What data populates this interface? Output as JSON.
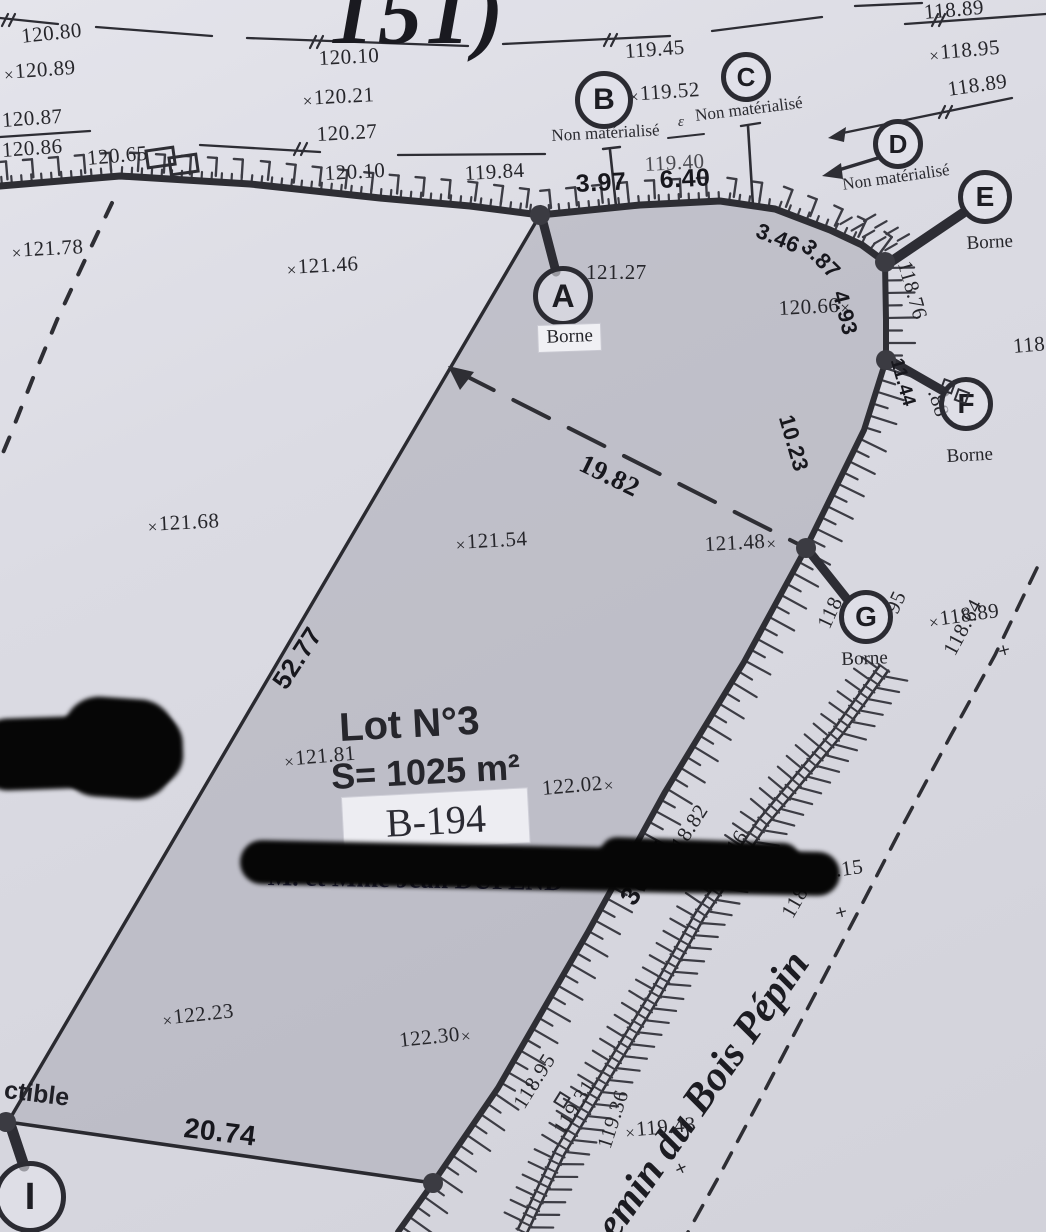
{
  "title_fragment": "151)",
  "labels": {
    "borne": "Borne",
    "non_materialise": "Non matérialisé",
    "constructible_fragment": "ctible",
    "epsilon_note": "ε",
    "cross_symbol": "×",
    "owner_fragment_left": "M"
  },
  "lot": {
    "name": "Lot N°3",
    "area": "S= 1025 m²",
    "parcel_id": "B-194",
    "owner": "M. et Mme Jean DUPEND"
  },
  "road": {
    "name": "Chemin du Bois Pépin"
  },
  "points": [
    {
      "id": "A",
      "x": 563,
      "y": 296,
      "rr": 30
    },
    {
      "id": "B",
      "x": 604,
      "y": 100,
      "rr": 29
    },
    {
      "id": "C",
      "x": 746,
      "y": 77,
      "rr": 25
    },
    {
      "id": "D",
      "x": 898,
      "y": 144,
      "rr": 25
    },
    {
      "id": "E",
      "x": 985,
      "y": 197,
      "rr": 27
    },
    {
      "id": "F",
      "x": 966,
      "y": 404,
      "rr": 27
    },
    {
      "id": "G",
      "x": 866,
      "y": 617,
      "rr": 27
    },
    {
      "id": "I",
      "x": 30,
      "y": 1197,
      "rr": 36
    }
  ],
  "borne_positions": [
    {
      "x": 538,
      "y": 326,
      "r": -2,
      "boxed": true
    },
    {
      "x": 966,
      "y": 233,
      "r": -3
    },
    {
      "x": 946,
      "y": 446,
      "r": -3
    },
    {
      "x": 841,
      "y": 649,
      "r": -2
    }
  ],
  "non_materialise_positions": [
    {
      "x": 551,
      "y": 126,
      "r": -3
    },
    {
      "x": 694,
      "y": 106,
      "r": -7
    },
    {
      "x": 841,
      "y": 175,
      "r": -8
    }
  ],
  "elevations": [
    {
      "v": "120.80",
      "x": 20,
      "y": 24,
      "r": -6
    },
    {
      "v": "120.89",
      "x": 2,
      "y": 60,
      "r": -4,
      "m": "l"
    },
    {
      "v": "120.87",
      "x": 1,
      "y": 108,
      "r": -4
    },
    {
      "v": "120.86",
      "x": 1,
      "y": 138,
      "r": -4
    },
    {
      "v": "120.65",
      "x": 86,
      "y": 146,
      "r": -5
    },
    {
      "v": "120.10",
      "x": 318,
      "y": 46,
      "r": -3
    },
    {
      "v": "120.21",
      "x": 301,
      "y": 86,
      "r": -3,
      "m": "l"
    },
    {
      "v": "120.27",
      "x": 316,
      "y": 122,
      "r": -3
    },
    {
      "v": "120.10",
      "x": 324,
      "y": 161,
      "r": -3
    },
    {
      "v": "119.84",
      "x": 464,
      "y": 161,
      "r": -3
    },
    {
      "v": "119.45",
      "x": 624,
      "y": 39,
      "r": -4
    },
    {
      "v": "119.52",
      "x": 627,
      "y": 82,
      "r": -4,
      "m": "l"
    },
    {
      "v": "118.89",
      "x": 923,
      "y": 0,
      "r": -5
    },
    {
      "v": "118.95",
      "x": 927,
      "y": 41,
      "r": -5,
      "m": "l"
    },
    {
      "v": "118.89",
      "x": 946,
      "y": 77,
      "r": -8
    },
    {
      "v": "121.78",
      "x": 10,
      "y": 238,
      "r": -3,
      "m": "l"
    },
    {
      "v": "121.46",
      "x": 285,
      "y": 255,
      "r": -3,
      "m": "l"
    },
    {
      "v": "121.27",
      "x": 586,
      "y": 260,
      "r": 0
    },
    {
      "v": "120.66",
      "x": 778,
      "y": 296,
      "r": -3,
      "m": "r"
    },
    {
      "v": "121.68",
      "x": 146,
      "y": 512,
      "r": -3,
      "m": "l"
    },
    {
      "v": "121.54",
      "x": 454,
      "y": 530,
      "r": -3,
      "m": "l"
    },
    {
      "v": "121.48",
      "x": 704,
      "y": 532,
      "r": -3,
      "m": "r"
    },
    {
      "v": "118.89",
      "x": 926,
      "y": 608,
      "r": -8,
      "m": "l"
    },
    {
      "v": "121.81",
      "x": 282,
      "y": 747,
      "r": -5,
      "m": "l"
    },
    {
      "v": "122.02",
      "x": 541,
      "y": 776,
      "r": -5,
      "m": "r"
    },
    {
      "v": "122.23",
      "x": 160,
      "y": 1006,
      "r": -6,
      "m": "l"
    },
    {
      "v": "122.30",
      "x": 398,
      "y": 1028,
      "r": -6,
      "m": "r"
    },
    {
      "v": "119.15",
      "x": 790,
      "y": 864,
      "r": -8,
      "m": "l"
    },
    {
      "v": "119.43",
      "x": 623,
      "y": 1118,
      "r": -5,
      "m": "l"
    },
    {
      "v": "118.76",
      "x": 916,
      "y": 258,
      "r": 74
    },
    {
      "v": "118.64",
      "x": 938,
      "y": 648,
      "r": -62
    },
    {
      "v": "118.82",
      "x": 660,
      "y": 850,
      "r": -57
    },
    {
      "v": "119.16",
      "x": 700,
      "y": 876,
      "r": -57
    },
    {
      "v": "118.99",
      "x": 776,
      "y": 910,
      "r": -60
    },
    {
      "v": "118.95",
      "x": 508,
      "y": 1100,
      "r": -58
    },
    {
      "v": "119.31",
      "x": 548,
      "y": 1126,
      "r": -58
    },
    {
      "v": "119.36",
      "x": 592,
      "y": 1144,
      "r": -72
    },
    {
      "v": "118",
      "x": 1012,
      "y": 334,
      "r": -5
    },
    {
      "v": "118",
      "x": 812,
      "y": 622,
      "r": -65
    },
    {
      "v": "95",
      "x": 880,
      "y": 607,
      "r": -65
    },
    {
      "v": ".88",
      "x": 946,
      "y": 386,
      "r": 72
    },
    {
      "v": "119.40",
      "x": 644,
      "y": 152,
      "r": -3,
      "cls": "faint"
    }
  ],
  "cross_marks": [
    {
      "x": 993,
      "y": 650,
      "r": -60
    },
    {
      "x": 830,
      "y": 912,
      "r": -60
    },
    {
      "x": 670,
      "y": 1170,
      "r": -70
    }
  ],
  "distances": [
    {
      "v": "3.97",
      "x": 575,
      "y": 170,
      "r": -3,
      "sz": 25
    },
    {
      "v": "6.40",
      "x": 659,
      "y": 166,
      "r": -3,
      "sz": 25
    },
    {
      "v": "3.46",
      "x": 762,
      "y": 218,
      "r": 22,
      "sz": 22
    },
    {
      "v": "3.87",
      "x": 814,
      "y": 234,
      "r": 45,
      "sz": 22
    },
    {
      "v": "4.93",
      "x": 852,
      "y": 288,
      "r": 76,
      "sz": 22
    },
    {
      "v": "11.44",
      "x": 906,
      "y": 356,
      "r": 74,
      "sz": 19
    },
    {
      "v": "10.23",
      "x": 798,
      "y": 412,
      "r": 74,
      "sz": 22
    },
    {
      "v": "19.82",
      "x": 588,
      "y": 448,
      "r": 26,
      "sz": 27,
      "serif": true
    },
    {
      "v": "52.77",
      "x": 266,
      "y": 678,
      "r": -57,
      "sz": 26
    },
    {
      "v": "36.05",
      "x": 614,
      "y": 894,
      "r": -57,
      "sz": 27
    },
    {
      "v": "20.74",
      "x": 186,
      "y": 1112,
      "r": 7,
      "sz": 28
    }
  ],
  "colors": {
    "paper": "#dadae2",
    "lot_fill": "#b6b6be",
    "ink": "#26262b",
    "ink_bold": "#17171d",
    "hatch": "#3c3c44",
    "redaction": "#060606",
    "owner_ink": "#232347"
  }
}
